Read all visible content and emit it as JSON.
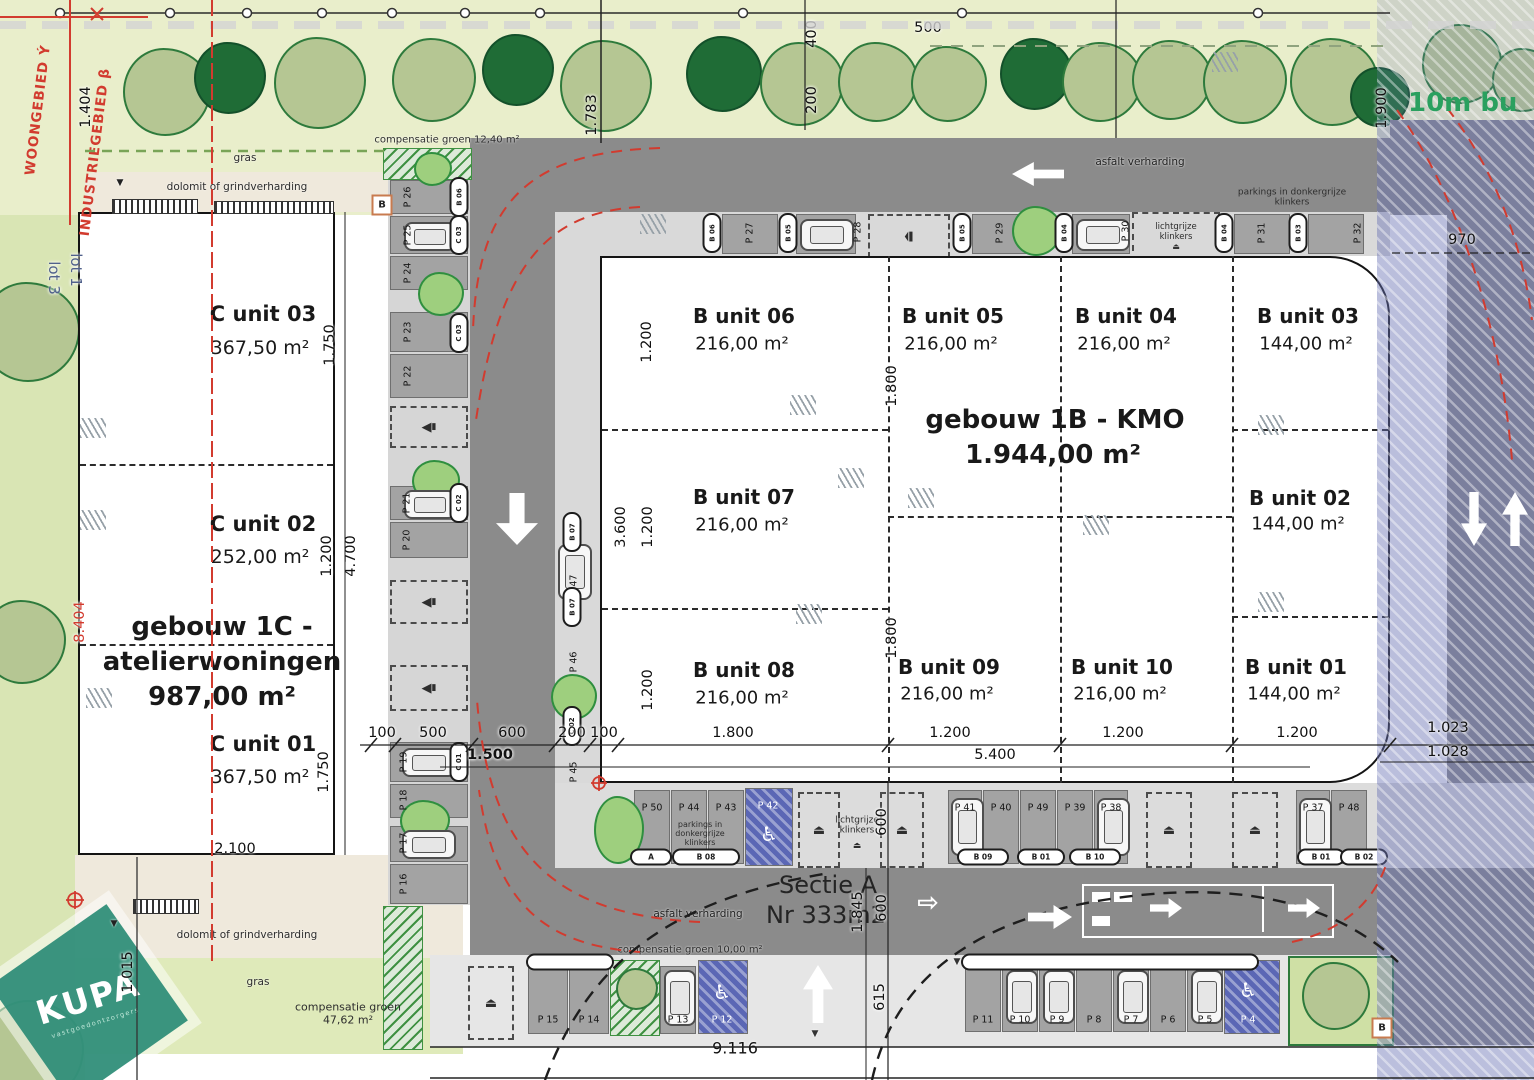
{
  "plan": {
    "boundary": {
      "woongebied": "WOONGEBIED Ý",
      "industriegebied": "INDUSTRIEGEBIED β",
      "lot1": "lot 1",
      "lot3": "lot 3"
    },
    "logo": {
      "name": "KUPA",
      "tagline": "vastgoedontzorgers"
    },
    "buffer_label": "10m bu",
    "markers": {
      "b_top": "B",
      "b_bottom": "B"
    },
    "surfaces": {
      "gras_top": "gras",
      "gras_bottom": "gras",
      "dolomit_top": "dolomit of grindverharding",
      "dolomit_bottom": "dolomit of grindverharding",
      "asfalt_top": "asfalt verharding",
      "asfalt_bottom": "asfalt verharding",
      "comp12": "compensatie groen 12,40 m²",
      "comp10": "compensatie groen 10,00 m²",
      "comp47_1": "compensatie groen",
      "comp47_2": "47,62 m²",
      "parkings_klinkers_top": "parkings in donkergrijze klinkers",
      "parkings_klinkers_bottom": "parkings in donkergrijze klinkers",
      "licht_top": "lichtgrijze klinkers",
      "licht_bottom": "lichtgrijze klinkers",
      "sectie_1": "Sectie A",
      "sectie_2": "Nr 333m2"
    },
    "gebouw_1c": {
      "title": "gebouw 1C  -",
      "subtitle": "atelierwoningen",
      "area": "987,00 m²",
      "units": [
        {
          "name": "C unit 03",
          "area": "367,50 m²"
        },
        {
          "name": "C unit 02",
          "area": "252,00 m²"
        },
        {
          "name": "C unit 01",
          "area": "367,50 m²"
        }
      ]
    },
    "gebouw_1b": {
      "title": "gebouw 1B - KMO",
      "area": "1.944,00 m²",
      "units": [
        {
          "name": "B unit 06",
          "area": "216,00 m²"
        },
        {
          "name": "B unit 05",
          "area": "216,00 m²"
        },
        {
          "name": "B unit 04",
          "area": "216,00 m²"
        },
        {
          "name": "B unit 03",
          "area": "144,00 m²"
        },
        {
          "name": "B unit 07",
          "area": "216,00 m²"
        },
        {
          "name": "B unit 02",
          "area": "144,00 m²"
        },
        {
          "name": "B unit 08",
          "area": "216,00 m²"
        },
        {
          "name": "B unit 09",
          "area": "216,00 m²"
        },
        {
          "name": "B unit 10",
          "area": "216,00 m²"
        },
        {
          "name": "B unit 01",
          "area": "144,00 m²"
        }
      ]
    },
    "parking": {
      "left_col": {
        "labels": [
          "P 26",
          "P 25",
          "P 24",
          "P 23",
          "P 22",
          "P 21",
          "P 20",
          "P 19",
          "P 18",
          "P 17",
          "P 16"
        ],
        "capsules": [
          "B 06",
          "C 03",
          "C 03",
          "C 02",
          "C 01"
        ]
      },
      "top_row": {
        "labels": [
          "P 27",
          "P 28",
          "P 29",
          "P 30",
          "P 31",
          "P 32"
        ],
        "capsules": [
          "B 06",
          "B 05",
          "B 05",
          "B 04",
          "B 04",
          "B 03"
        ]
      },
      "mid_col": {
        "labels": [
          "P 47",
          "P 46",
          "P 45"
        ],
        "capsules": [
          "B 07",
          "B 07",
          "C 02"
        ]
      },
      "bottom_strip": {
        "labels": [
          "P 50",
          "P 44",
          "P 43",
          "P 42",
          "P 41",
          "P 40",
          "P 49",
          "P 39",
          "P 38",
          "P 37",
          "P 48"
        ],
        "capsules": [
          "A",
          "B 08",
          "B 09",
          "B 01",
          "B 10",
          "B 01",
          "B 02"
        ]
      },
      "bottom_row": {
        "labels": [
          "P 15",
          "P 14",
          "P 13",
          "P 12",
          "P 11",
          "P 10",
          "P 9",
          "P 8",
          "P 7",
          "P 6",
          "P 5",
          "P 4"
        ]
      }
    },
    "dimensions": {
      "d1404": "1.404",
      "d500": "500",
      "d1783": "1.783",
      "d400": "400",
      "d200": "200",
      "d1900": "1.900",
      "d970": "970",
      "c1750a": "1.750",
      "c1200": "1.200",
      "c4700": "4.700",
      "c1750b": "1.750",
      "c2100": "2.100",
      "c8404": "8.404",
      "d1015": "1.015",
      "b1200a": "1.200",
      "b1800a": "1.800",
      "b3600": "3.600",
      "b1200b": "1.200",
      "b1200c": "1.200",
      "b1800b": "1.800",
      "w100a": "100",
      "w500": "500",
      "w600": "600",
      "w200": "200",
      "w100b": "100",
      "w1800": "1.800",
      "w1200a": "1.200",
      "w1200b": "1.200",
      "w1200c": "1.200",
      "w1500": "1.500",
      "w5400": "5.400",
      "r1023": "1.023",
      "r1028": "1.028",
      "s600a": "600",
      "s600b": "600",
      "s1845": "1.845",
      "s615": "615",
      "w9116": "9.116"
    }
  }
}
